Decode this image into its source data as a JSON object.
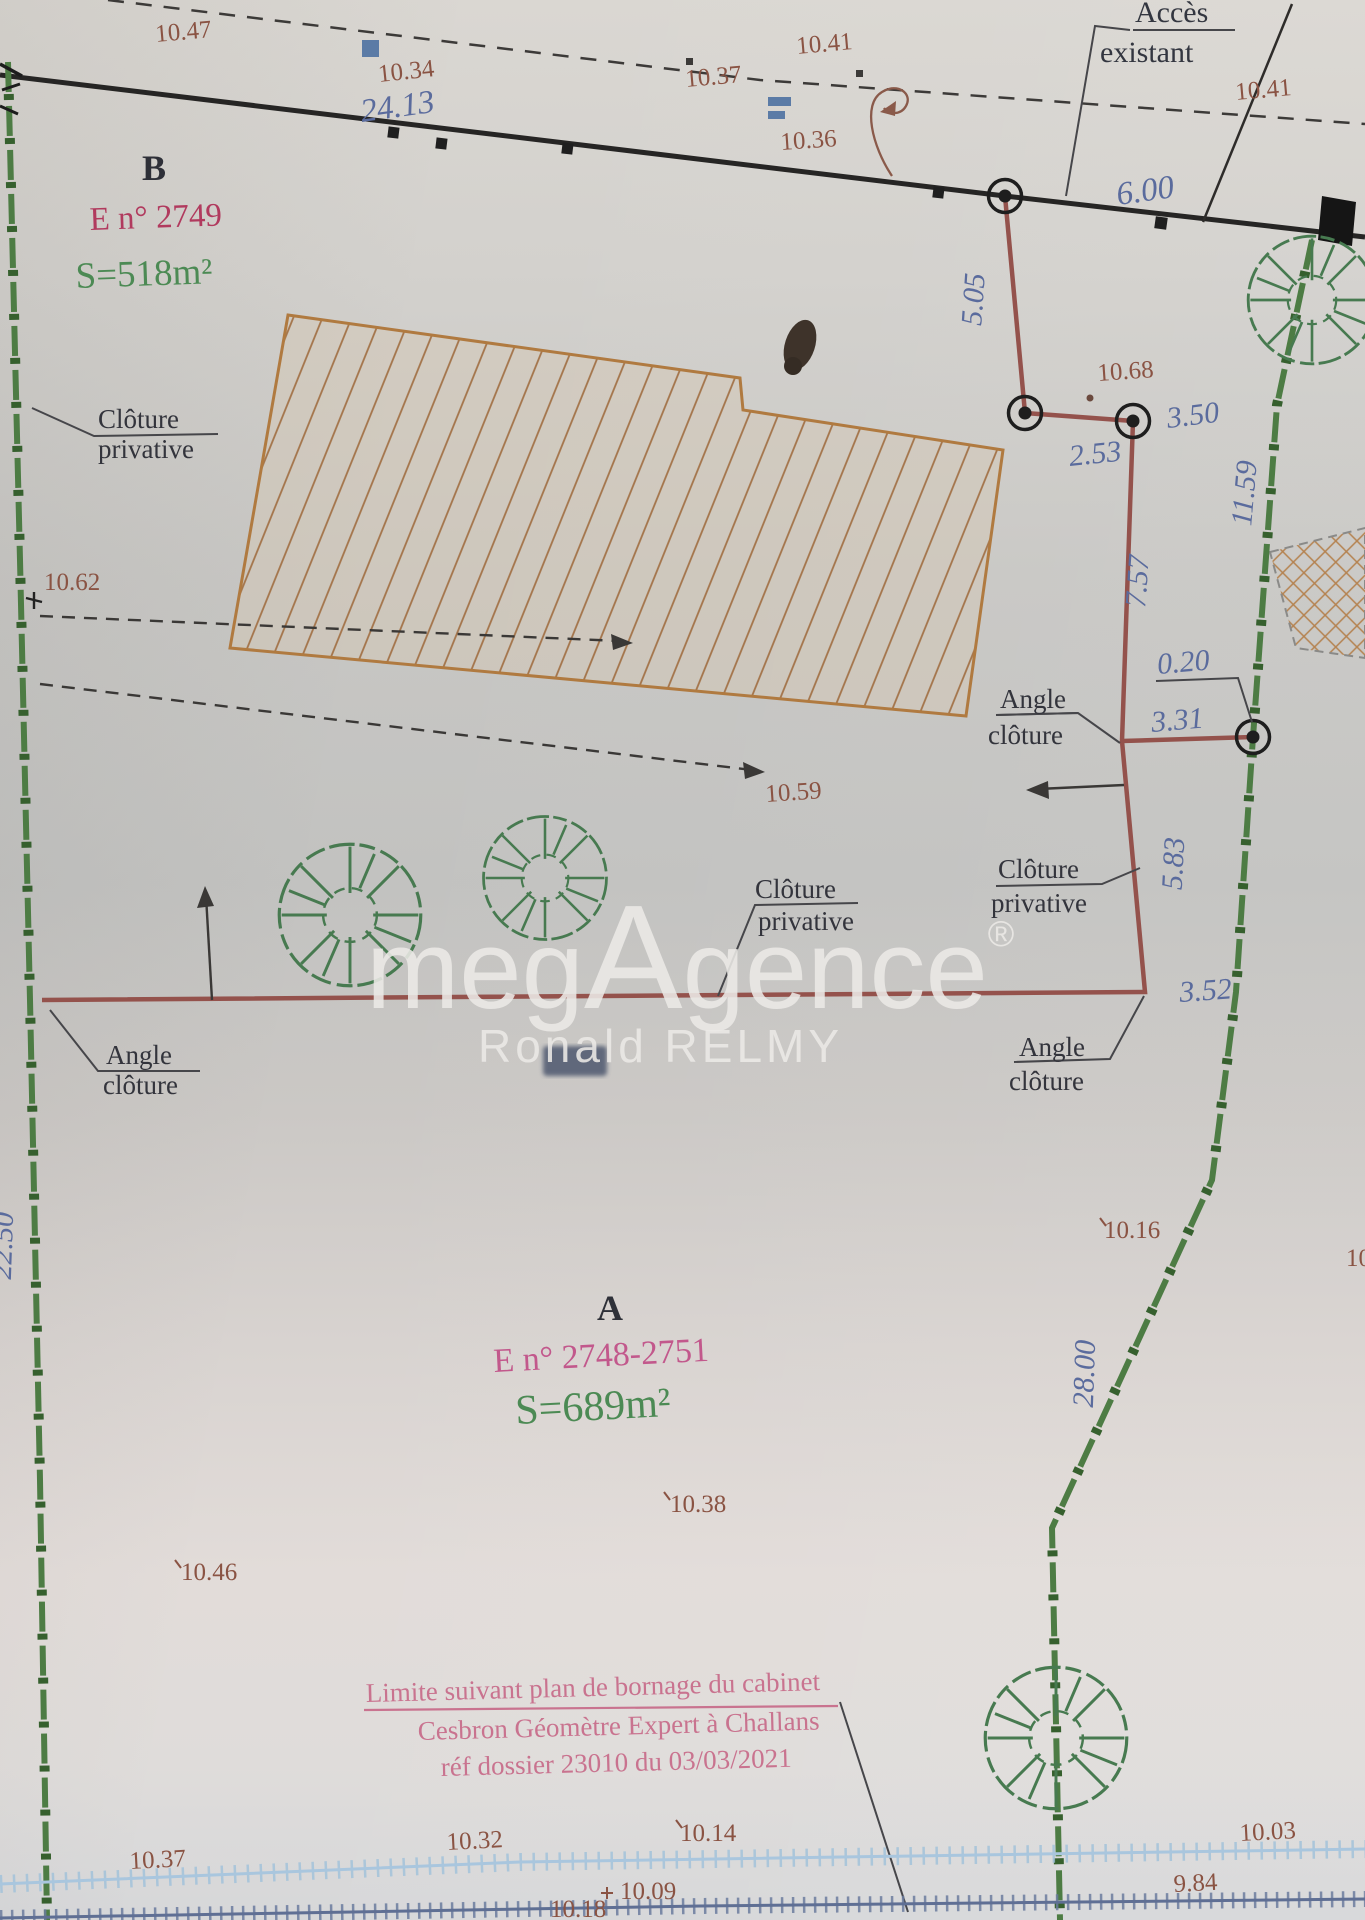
{
  "parcels": {
    "b": {
      "letter": "B",
      "lot": "E n° 2749",
      "area": "S=518m²"
    },
    "a": {
      "letter": "A",
      "lot": "E n° 2748-2751",
      "area": "S=689m²"
    }
  },
  "labels": {
    "acces_1": "Accès",
    "acces_2": "existant",
    "angle": "Angle",
    "cloture_lc": "clôture",
    "cloture": "Clôture",
    "privative": "privative"
  },
  "dims": {
    "v24_13": "24.13",
    "v6_00": "6.00",
    "v5_05": "5.05",
    "v2_53": "2.53",
    "v3_50": "3.50",
    "v7_57": "7.57",
    "v0_20": "0.20",
    "v3_31": "3.31",
    "v5_83": "5.83",
    "v3_52": "3.52",
    "v11_59": "11.59",
    "v28_00": "28.00",
    "v22_50": "22.50"
  },
  "elevations": {
    "top_1": "10.47",
    "top_2": "10.34",
    "top_3": "10.37",
    "top_4": "10.41",
    "top_5": "10.36",
    "top_right": "10.41",
    "mid_1": "10.68",
    "mid_2": "10.62",
    "mid_3": "10.59",
    "mid_4": "10.16",
    "low_1": "10.38",
    "low_2": "10.46",
    "bot_1": "10.37",
    "bot_2": "10.32",
    "bot_3": "10.14",
    "bot_4": "10.03",
    "bot_5": "9.84",
    "bot_6": "10.09",
    "bot_7": "10.18",
    "bot_edge_partial": "10"
  },
  "note": {
    "l1": "Limite suivant plan de bornage du cabinet",
    "l2": "Cesbron Géomètre Expert à Challans",
    "l3": "réf dossier 23010 du 03/03/2021"
  },
  "watermark": {
    "m1": "meg",
    "m2": "A",
    "m3": "gence",
    "reg": "®",
    "agent": "Ronald RELMY"
  },
  "colors": {
    "fence_red": "#94524c",
    "boundary_green": "#4a7a42",
    "dim_blue": "#5a6b9d",
    "elev_brown": "#8a5343",
    "parcel_crimson": "#b13a5e",
    "parcel_pink": "#c2588c",
    "area_green": "#4c8a54",
    "note_pink": "#c9738f",
    "line_black": "#2e2c2a",
    "building_hatch": "#a3744a",
    "path_blue": "#a9c6de"
  }
}
